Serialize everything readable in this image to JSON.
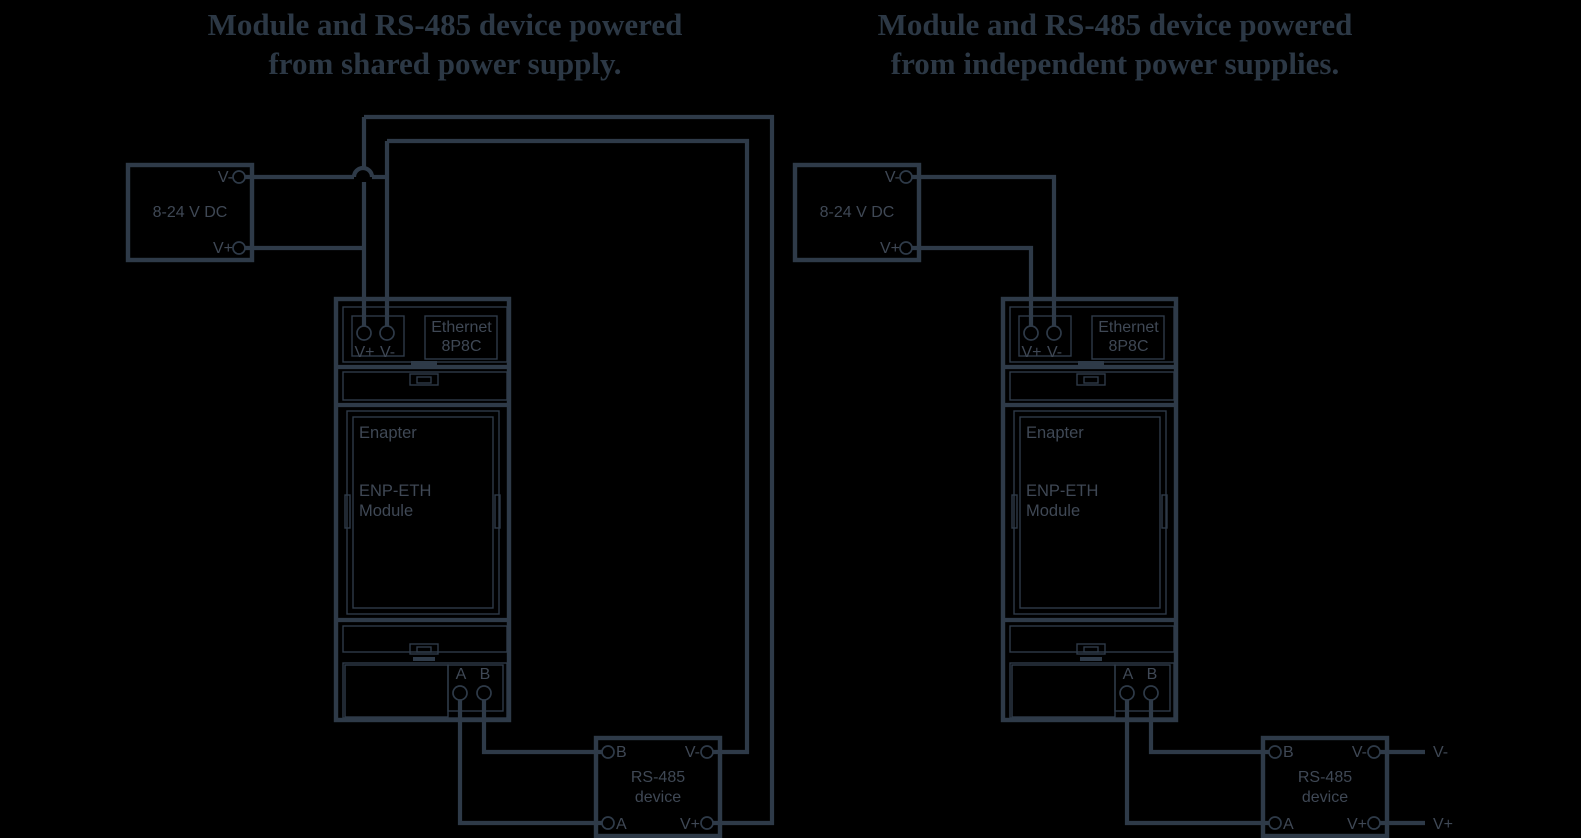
{
  "theme": {
    "background_color": "#000000",
    "line_color": "#2e3a48",
    "label_color": "#3f4855",
    "title_color": "#2c3845"
  },
  "left_diagram": {
    "title_line1": "Module and RS-485 device powered",
    "title_line2": "from shared power supply.",
    "power_supply": {
      "label": "8-24 V DC",
      "vminus": "V-",
      "vplus": "V+"
    },
    "module": {
      "vplus": "V+",
      "vminus": "V-",
      "ethernet_line1": "Ethernet",
      "ethernet_line2": "8P8C",
      "brand": "Enapter",
      "model_line1": "ENP-ETH",
      "model_line2": "Module",
      "a": "A",
      "b": "B"
    },
    "rs485": {
      "b": "B",
      "vminus": "V-",
      "a": "A",
      "vplus": "V+",
      "name_line1": "RS-485",
      "name_line2": "device"
    }
  },
  "right_diagram": {
    "title_line1": "Module and RS-485 device powered",
    "title_line2": "from independent power supplies.",
    "power_supply": {
      "label": "8-24 V DC",
      "vminus": "V-",
      "vplus": "V+"
    },
    "module": {
      "vplus": "V+",
      "vminus": "V-",
      "ethernet_line1": "Ethernet",
      "ethernet_line2": "8P8C",
      "brand": "Enapter",
      "model_line1": "ENP-ETH",
      "model_line2": "Module",
      "a": "A",
      "b": "B"
    },
    "rs485": {
      "b": "B",
      "vminus": "V-",
      "a": "A",
      "vplus": "V+",
      "name_line1": "RS-485",
      "name_line2": "device"
    },
    "external": {
      "vminus": "V-",
      "vplus": "V+"
    }
  }
}
